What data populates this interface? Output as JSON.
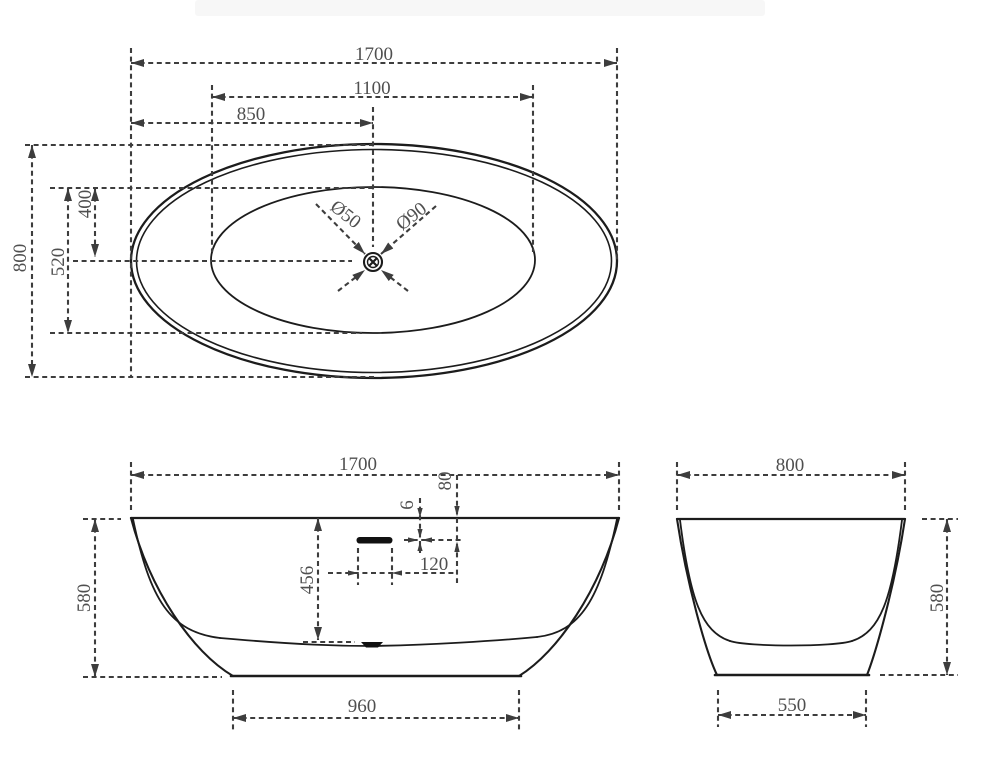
{
  "title": "bathtub-three-view-dimension-drawing",
  "colors": {
    "outline": "#1c1c1c",
    "dimension": "#3d3d3d",
    "label_text": "#4f4f4f",
    "background": "#ffffff"
  },
  "views": {
    "top": {
      "length": "1700",
      "basin_length": "1100",
      "drain_from_end": "850",
      "width": "800",
      "basin_width": "520",
      "basin_top_to_drain": "400",
      "drain_hole_dia": "Ø50",
      "drain_flange_dia": "Ø90"
    },
    "front": {
      "length": "1700",
      "height": "580",
      "interior_depth": "456",
      "overflow_slot_height": "6",
      "overflow_below_rim": "80",
      "overflow_slot_width": "120",
      "base_length": "960"
    },
    "side": {
      "width": "800",
      "height": "580",
      "base_width": "550"
    }
  }
}
